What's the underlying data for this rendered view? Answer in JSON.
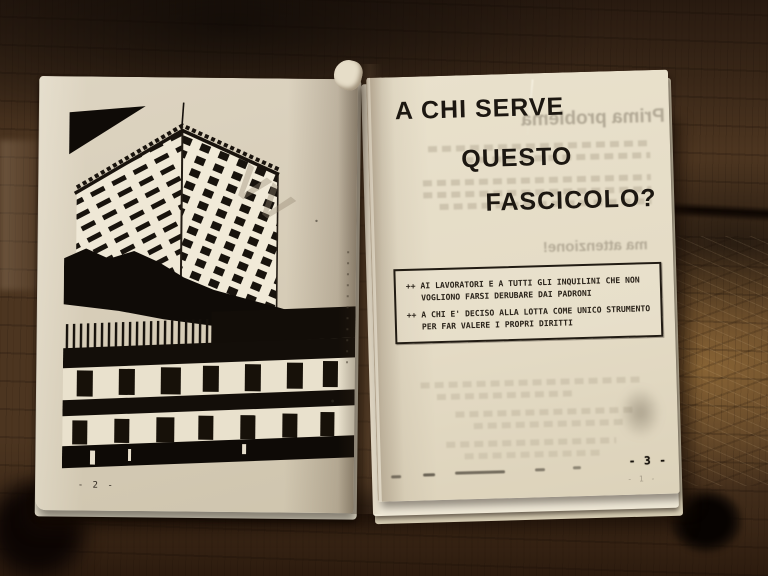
{
  "left_page": {
    "page_number": "- 2 -"
  },
  "right_page": {
    "title_line1": "A CHI SERVE",
    "title_line2": "QUESTO",
    "title_line3": "FASCICOLO?",
    "box_item1_bullet": "++",
    "box_item1_text": "AI LAVORATORI E A TUTTI GLI INQUILINI CHE NON VOGLIONO FARSI DERUBARE DAI PADRONI",
    "box_item2_bullet": "++",
    "box_item2_text": "A CHI E' DECISO ALLA LOTTA COME UNICO STRUMENTO PER FAR VALERE I PROPRI DIRITTI",
    "page_number": "- 3 -",
    "page_number_ghost": "- 1 -",
    "show_through_header": "Prima problema",
    "show_through_note": "ma attenzione!"
  },
  "photo": {
    "ghost_mark": "VV"
  },
  "colors": {
    "page_left": "#d6ccb7",
    "page_right": "#e4dbc5",
    "ink": "#1c1711",
    "wood_dark": "#352414",
    "wood_light": "#7d5c35"
  }
}
